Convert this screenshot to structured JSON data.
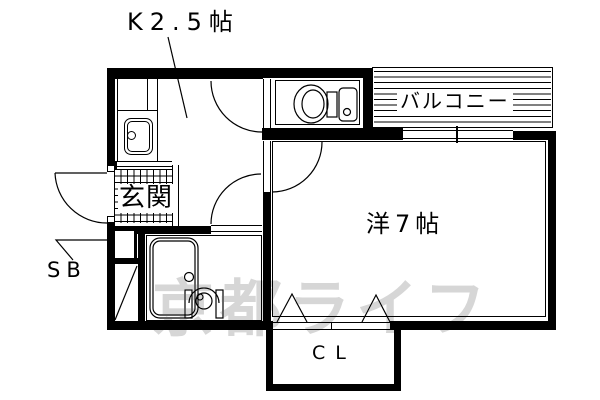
{
  "plan": {
    "labels": {
      "kitchen": "K2.5帖",
      "balcony": "バルコニー",
      "entrance": "玄関",
      "room": "洋7帖",
      "shoebox": "SB",
      "closet": "CL"
    },
    "watermark": "京都ライフ",
    "colors": {
      "line": "#000000",
      "background": "#ffffff",
      "watermark": "#d6d6d6"
    }
  }
}
